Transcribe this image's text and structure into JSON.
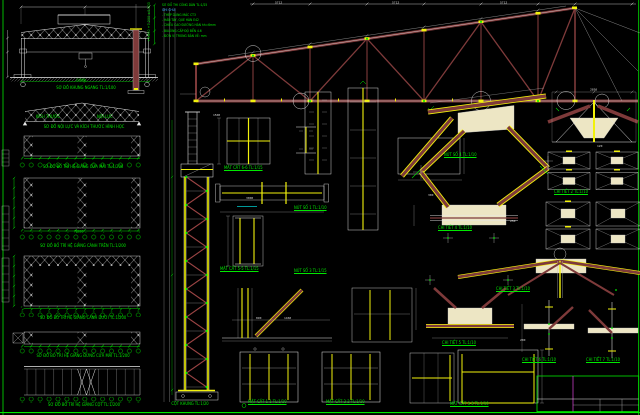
{
  "sheet": {
    "background": "#000000",
    "colors": {
      "line_white": "#E8E8E8",
      "text_green": "#00E800",
      "plate_yellow": "#F2F20C",
      "member_maroon": "#7E3A3A",
      "gusset_cream": "#EDE6C4",
      "accent_magenta": "#DD44DD",
      "accent_cyan": "#00CCCC"
    }
  },
  "titles": {
    "khung_ngang": "SƠ ĐỒ KHUNG NGANG TL:1/100",
    "noi_luc": "SƠ ĐỒ NỘI LỰC VÀ KÍCH THƯỚC HÌNH HỌC",
    "sub_left": "KÍCH THƯỚC",
    "sub_right": "NỘI LỰC",
    "plan_cua_mai": "SƠ ĐỒ BỐ TRÍ HỆ GIẰNG CỬA MÁI TL:1/200",
    "plan_canh_tren": "SƠ ĐỒ BỐ TRÍ HỆ GIẰNG CÁNH TRÊN TL:1/200",
    "plan_canh_duoi": "SƠ ĐỒ BỐ TRÍ HỆ GIẰNG CÁNH DƯỚI TL:1/200",
    "plan_dung_cua_mai": "SƠ ĐỒ BỐ TRÍ HỆ GIẰNG ĐỨNG CỬA MÁI TL:1/200",
    "plan_cot": "SƠ ĐỒ BỐ TRÍ HỆ GIẰNG CỘT TL:1/200"
  },
  "notes": {
    "line1": "SƠ ĐỒ THI CÔNG DÀN TL:1/25",
    "line2": "GHI CHÚ:",
    "line3": "- THÉP DÙNG MÁC CT3",
    "line4": "- HÀN TAY, QUE HÀN E42",
    "line5": "- CHIỀU CAO ĐƯỜNG HÀN hh=6mm",
    "line6": "- BULÔNG CẤP ĐỘ BỀN 4.6",
    "line7": "- ĐƠN VỊ TRONG BẢN VẼ: mm"
  },
  "labels": {
    "cot_khung": "CỘT KHUNG TL:1/20",
    "mc66": "MẶT CẮT 6-6 TL:1/15",
    "mc55": "MẶT CẮT 5-5 TL:1/15",
    "nut1": "NÚT SỐ 1 TL:1/10",
    "nut3": "NÚT SỐ 3 TL:1/15",
    "nut4": "NÚT SỐ 4 TL:1/10",
    "ct2": "CHI TIẾT 2 TL:1/10",
    "ct3": "CHI TIẾT 3 TL:1/10",
    "ct4": "CHI TIẾT 4 TL:1/10",
    "ct5": "CHI TIẾT 5 TL:1/10",
    "ct6": "CHI TIẾT 6 TL:1/10",
    "ct7": "CHI TIẾT 7 TL:1/10",
    "mc11": "MẶT CẮT 1-1 TL:1/10",
    "mc22": "MẶT CẮT 2-2 TL:1/10",
    "mc33": "MẶT CẮT 3-3 TL:1/10"
  },
  "dims": {
    "white": [
      "5712",
      "5712",
      "5712",
      "2850",
      "1500",
      "3000",
      "890",
      "1460",
      "250",
      "300",
      "200",
      "120"
    ],
    "green_span_frame": "24000",
    "green_span_plan": "78000",
    "elevations": "+9.600  +7.200  ±0.000"
  }
}
